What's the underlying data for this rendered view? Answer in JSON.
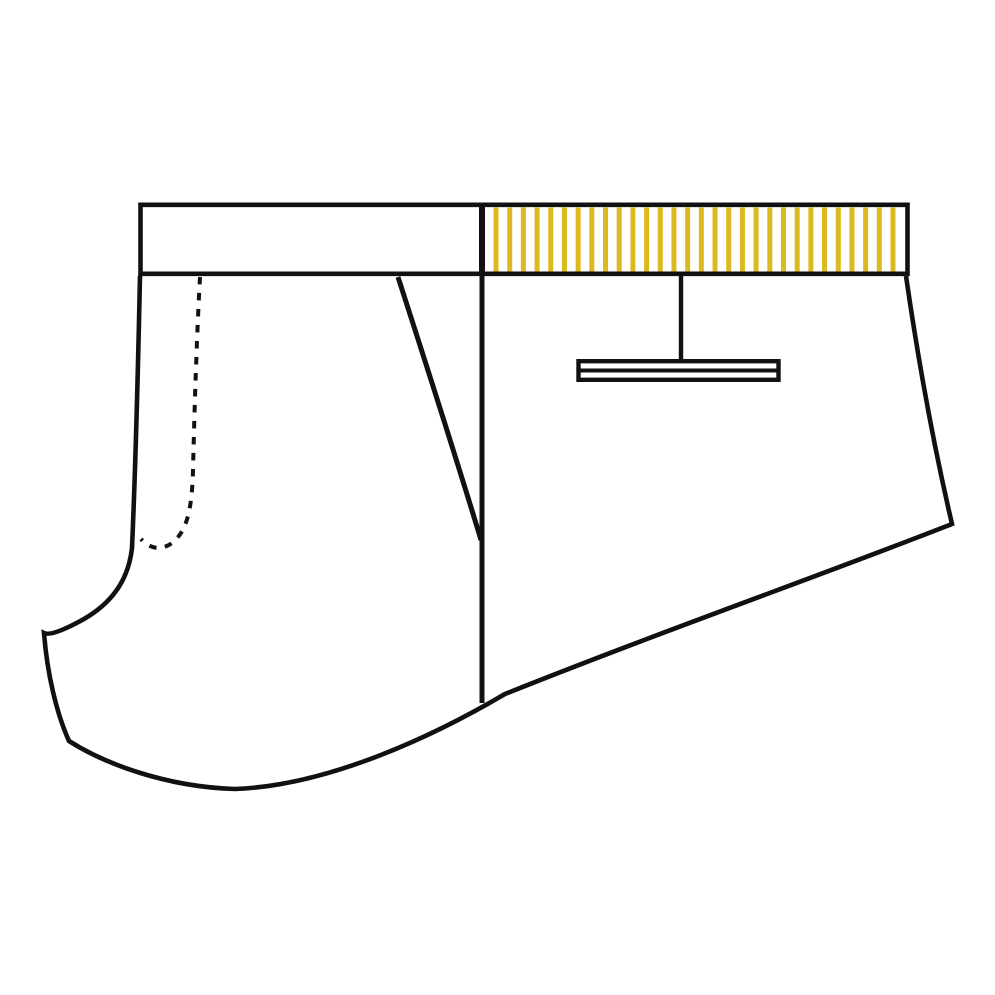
{
  "canvas": {
    "width": 995,
    "height": 995,
    "background": "#ffffff"
  },
  "drawing": {
    "alt": "Technical flat sketch of shorts, side view, with striped waistband and back welt pocket",
    "ink": "#111111",
    "paper": "#ffffff",
    "dash_pattern": "7.5 8.5",
    "body_outline_path": "M 140,276 C 138,370 135,480 132,548 C 128,584 108,605 84,619 C 66,629 50,636 44,633 C 47,672 56,712 69,741 C 105,764 167,787 235,789 C 320,786 420,744 505,694 C 660,632 830,572 952,524 C 930,430 916,345 906,276",
    "waistband_path": "M 140.5,204.8 L 907.5,204.8 L 907.5,273.8 L 140.5,273.8 Z",
    "waistband_divider_path": "M 482,202.5 L 482,276",
    "side_seam_path": "M 482,276 L 482,703",
    "front_pocket_dashed_path": "M 200,277 C 196,350 194,430 193,470 C 192,512 186,532 172,543 C 161,551 150,549 141,539",
    "pocket_opening_path": "M 398,277 C 428,370 462,477 481,540",
    "back_pocket_stitch_path": "M 681,276 L 681,361",
    "back_pocket_welt_path": "M 578.5,361.2 L 778.5,361.2 L 778.5,379.8 L 578.5,379.8 Z",
    "back_pocket_welt_mid_path": "M 580,370.5 L 777,370.5",
    "stripes": {
      "count": 30,
      "x_first": 496,
      "x_last": 893,
      "y_top": 207.5,
      "y_bottom": 271.5,
      "width": 5,
      "color": "#DDB91F"
    }
  }
}
